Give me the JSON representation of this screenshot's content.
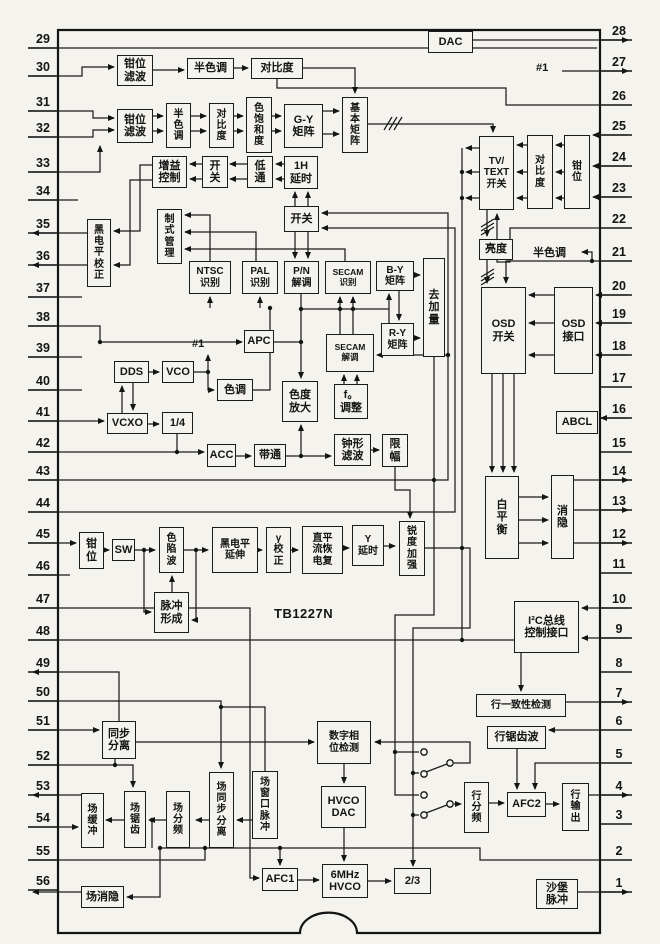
{
  "part": {
    "number": "TB1227N"
  },
  "annotations": {
    "ref1": "#1",
    "ref2": "#1",
    "halftone_in": "半色调"
  },
  "pins": {
    "left": [
      "29",
      "30",
      "31",
      "32",
      "33",
      "34",
      "35",
      "36",
      "37",
      "38",
      "39",
      "40",
      "41",
      "42",
      "43",
      "44",
      "45",
      "46",
      "47",
      "48",
      "49",
      "50",
      "51",
      "52",
      "53",
      "54",
      "55",
      "56"
    ],
    "right": [
      "28",
      "27",
      "26",
      "25",
      "24",
      "23",
      "22",
      "21",
      "20",
      "19",
      "18",
      "17",
      "16",
      "15",
      "14",
      "13",
      "12",
      "11",
      "10",
      "9",
      "8",
      "7",
      "6",
      "5",
      "4",
      "3",
      "2",
      "1"
    ]
  },
  "blocks": {
    "qwlb1": {
      "label": "钳位\n滤波"
    },
    "bsd1": {
      "label": "半色调"
    },
    "dbd1": {
      "label": "对比度"
    },
    "qwlb2": {
      "label": "钳位\n滤波"
    },
    "bsd2": {
      "label": "半\n色\n调"
    },
    "dbd2": {
      "label": "对\n比\n度"
    },
    "sbhd": {
      "label": "色\n饱\n和\n度"
    },
    "gy": {
      "label": "G-Y\n矩阵"
    },
    "jbjz": {
      "label": "基\n本\n矩\n阵"
    },
    "zykz": {
      "label": "增益\n控制"
    },
    "kg1": {
      "label": "开\n关"
    },
    "dt": {
      "label": "低\n通"
    },
    "h1h": {
      "label": "1H\n延时"
    },
    "kg2": {
      "label": "开关"
    },
    "hdpjz": {
      "label": "黑\n电\n平\n校\n正"
    },
    "zsgl": {
      "label": "制\n式\n管\n理"
    },
    "ntsc": {
      "label": "NTSC\n识别"
    },
    "pal": {
      "label": "PAL\n识别"
    },
    "pn": {
      "label": "P/N\n解调"
    },
    "secam1": {
      "label": "SECAM\n识别"
    },
    "by": {
      "label": "B-Y\n矩阵"
    },
    "qjl": {
      "label": "去\n加\n量"
    },
    "apc": {
      "label": "APC"
    },
    "secam2": {
      "label": "SECAM\n解调"
    },
    "ry": {
      "label": "R-Y\n矩阵"
    },
    "dds": {
      "label": "DDS"
    },
    "vco": {
      "label": "VCO"
    },
    "sd": {
      "label": "色调"
    },
    "sdfd": {
      "label": "色度\n放大"
    },
    "vcxo": {
      "label": "VCXO"
    },
    "quarter": {
      "label": "1/4"
    },
    "f0": {
      "label": "f。\n调整"
    },
    "acc": {
      "label": "ACC"
    },
    "bt": {
      "label": "带通"
    },
    "zxlb": {
      "label": "钟形\n滤波"
    },
    "xf": {
      "label": "限\n幅"
    },
    "qw45": {
      "label": "钳\n位"
    },
    "sw": {
      "label": "SW"
    },
    "sxb": {
      "label": "色\n陷\n波"
    },
    "hdpys": {
      "label": "黑电平\n延伸"
    },
    "gamma": {
      "label": "γ\n校\n正"
    },
    "dclh": {
      "label": "直平\n流恢\n电复"
    },
    "yys": {
      "label": "Y\n延时"
    },
    "rdjq": {
      "label": "锐\n度\n加\n强"
    },
    "mcxc": {
      "label": "脉冲\n形成"
    },
    "tbfl": {
      "label": "同步\n分离"
    },
    "szxw": {
      "label": "数字相\n位检测"
    },
    "chc": {
      "label": "场\n缓\n冲"
    },
    "cjc": {
      "label": "场\n锯\n齿"
    },
    "cfp": {
      "label": "场\n分\n频"
    },
    "ctbfl": {
      "label": "场\n同\n步\n分\n离"
    },
    "ckmc": {
      "label": "场\n窗\n口\n脉\n冲"
    },
    "hvcodac": {
      "label": "HVCO\nDAC"
    },
    "afc1": {
      "label": "AFC1"
    },
    "hvco6": {
      "label": "6MHz\nHVCO"
    },
    "r23": {
      "label": "2/3"
    },
    "cxy": {
      "label": "场消隐"
    },
    "hyzx": {
      "label": "行一致性检测"
    },
    "hjcb": {
      "label": "行锯齿波"
    },
    "hfp": {
      "label": "行\n分\n频"
    },
    "afc2": {
      "label": "AFC2"
    },
    "hsc": {
      "label": "行\n输\n出"
    },
    "sbmc": {
      "label": "沙堡\n脉冲"
    },
    "i2c": {
      "label": "I²C总线\n控制接口"
    },
    "bph": {
      "label": "白\n平\n衡"
    },
    "xy": {
      "label": "消\n隐"
    },
    "abcl": {
      "label": "ABCL"
    },
    "osdkg": {
      "label": "OSD\n开关"
    },
    "osdjk": {
      "label": "OSD\n接口"
    },
    "ld": {
      "label": "亮度"
    },
    "tvtext": {
      "label": "TV/\nTEXT\n开关"
    },
    "dbd3": {
      "label": "对\n比\n度"
    },
    "qw3": {
      "label": "钳\n位"
    },
    "dac": {
      "label": "DAC"
    }
  }
}
